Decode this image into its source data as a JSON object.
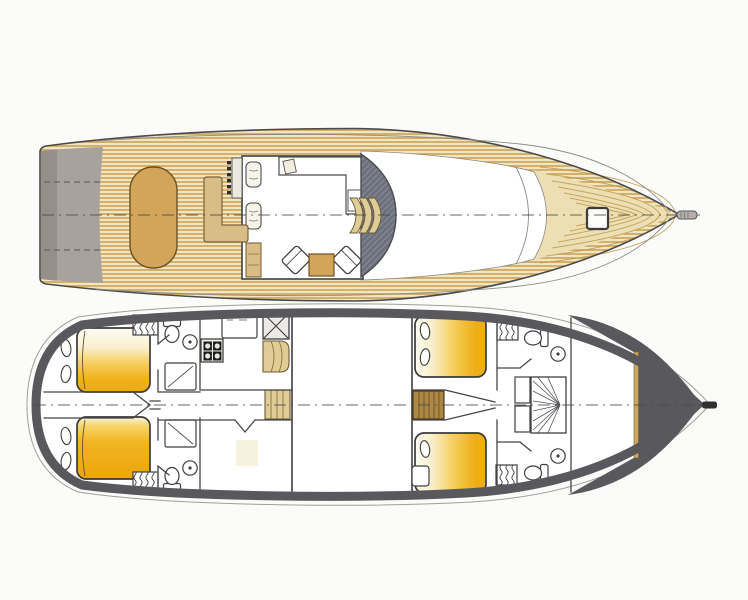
{
  "diagram": {
    "type": "yacht-deck-plans",
    "views": [
      {
        "id": "main-deck",
        "elements": [
          "swim-platform",
          "teak-aft-deck",
          "cockpit-table",
          "l-shaped-settee",
          "helm-console",
          "helm-seats",
          "deck-saloon",
          "galley-counter",
          "counter-sink",
          "armchair-port",
          "armchair-starboard",
          "coffee-table",
          "bar-cabinet",
          "curved-windshield",
          "companionway-steps",
          "coach-roof",
          "foredeck",
          "deck-hatch",
          "bowsprit",
          "centerline"
        ]
      },
      {
        "id": "lower-deck",
        "elements": [
          "aft-cabin-port",
          "aft-cabin-starboard",
          "double-bed-aft-port",
          "double-bed-aft-starboard",
          "wardrobe-aft-port",
          "wardrobe-aft-starboard",
          "bathroom-aft-port",
          "bathroom-aft-starboard",
          "toilet",
          "washbasin",
          "shower",
          "galley-stove",
          "galley-counter",
          "dumbwaiter-hatch",
          "curved-stairs",
          "aft-stairs",
          "corridor",
          "mid-cabin",
          "engine-room",
          "guest-cabin-port",
          "guest-cabin-starboard",
          "double-bed-fwd-port",
          "double-bed-fwd-starboard",
          "mid-stairs",
          "bathroom-fwd-port",
          "bathroom-fwd-starboard",
          "shower-room",
          "wardrobe-fwd-port",
          "wardrobe-fwd-starboard",
          "forepeak",
          "stem-fitting",
          "centerline"
        ]
      }
    ]
  },
  "colors": {
    "paper": "#fbfbfa",
    "line": "#45454a",
    "hullOutline": "#4b4b4e",
    "hullGray": "#a7a29b",
    "hullGrayDark": "#948f89",
    "hullDark": "#59595d",
    "teakBg": "#f2e6c0",
    "teakLine": "#c79e54",
    "teakBow": "#ecdfb4",
    "teakBowLine": "#bf9a4e",
    "woodMid": "#d2a558",
    "woodEdge": "#6d5122",
    "woodLight": "#d9bd86",
    "stepsTan": "#e0cc97",
    "stepsEdge": "#6b5a33",
    "stepsBrown": "#ad8743",
    "windshield": "#6e707c",
    "windshieldHatch": "#9aa2b2",
    "wall": "#46464a",
    "fixture": "#3f3f44",
    "goldLine": "#c9a95f",
    "bedGold": "#efae14"
  }
}
